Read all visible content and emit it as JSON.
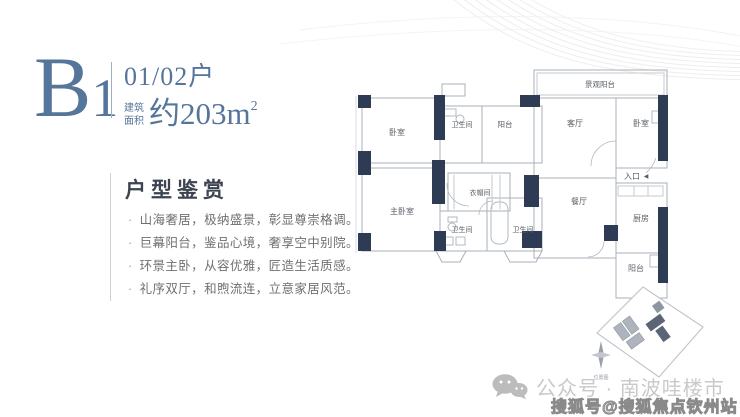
{
  "unit": {
    "code_letter": "B",
    "code_number": "1",
    "households": "01/02户",
    "area_label_top": "建筑",
    "area_label_bottom": "面积",
    "area_value": "约203m",
    "area_superscript": "2"
  },
  "appreciation": {
    "title": "户型鉴赏",
    "bullet": "·",
    "features": [
      "山海奢居，极纳盛景，彰显尊崇格调。",
      "巨幕阳台，鉴品心境，奢享空中别院。",
      "环景主卧，从容优雅，匠造生活质感。",
      "礼序双厅，和煦流连，立意家居风范。"
    ]
  },
  "floorplan": {
    "rooms": {
      "bedroom_top": "卧室",
      "bath_top": "卫生间",
      "balcony_top": "阳台",
      "view_balcony": "景观阳台",
      "living_room": "客厅",
      "bedroom_right": "卧室",
      "entrance": "入口",
      "entrance_arrow": "◀",
      "master_bedroom": "主卧室",
      "cloakroom": "衣帽间",
      "bath_left": "卫生间",
      "bath_right": "卫生间",
      "dining_room": "餐厅",
      "kitchen": "厨房",
      "balcony_bottom": "阳台"
    },
    "siteplan": {
      "caption": "位置图"
    }
  },
  "watermarks": {
    "wechat": "公众号 · 南波哇楼市",
    "sohu": "搜狐号@搜狐焦点钦州站"
  },
  "colors": {
    "accent_blue": "#56759a",
    "wall_dark": "#2e3b54",
    "plan_line": "#a9b0ba",
    "watermark_light": "#c9c9c9",
    "watermark_outline": "#8a8a8a"
  }
}
